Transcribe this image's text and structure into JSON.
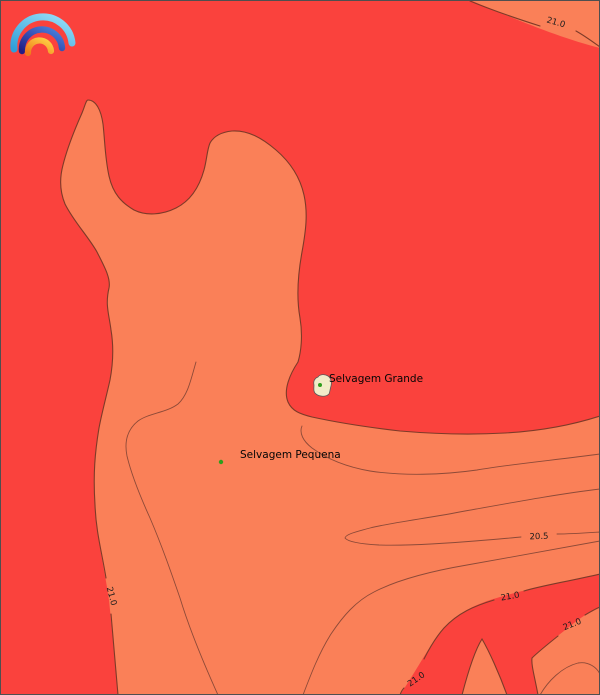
{
  "map": {
    "type": "filled-contour-temperature-map",
    "colors": {
      "fill_red": "#fa423d",
      "fill_salmon": "#fa8058",
      "contour_line": "#7e3a28",
      "thin_contour_line": "#8d4a38",
      "label_text": "#1c1c1c",
      "island_fill": "#f2ecc8",
      "island_dot": "#2f9e1c",
      "frame": "#4f4f4f"
    },
    "contour_labels": [
      {
        "id": "top-right",
        "text": "21.0"
      },
      {
        "id": "left-side",
        "text": "21.0"
      },
      {
        "id": "mid-right",
        "text": "20.5"
      },
      {
        "id": "band-upper",
        "text": "21.0"
      },
      {
        "id": "band-lower",
        "text": "21.0"
      },
      {
        "id": "band-tip",
        "text": "21.0"
      }
    ],
    "islands": [
      {
        "label": "Selvagem Grande"
      },
      {
        "label": "Selvagem Pequena"
      }
    ],
    "logo": {
      "name": "rainbow-weather-logo",
      "arc_colors": [
        "#49b6e9",
        "#2b2f9e",
        "#f6a21f"
      ]
    }
  },
  "chart_data": {
    "type": "heatmap",
    "subtype": "filled_contour_map",
    "title": "",
    "levels": [
      20.5,
      21.0
    ],
    "level_unit_hint": "temperature contours",
    "regions": [
      {
        "fill": "warm red",
        "meaning": "values above 21.0 contour"
      },
      {
        "fill": "salmon",
        "meaning": "values between 20.5 and 21.0"
      }
    ],
    "annotations": [
      "Selvagem Grande",
      "Selvagem Pequena"
    ],
    "grid": false,
    "legend": false
  }
}
